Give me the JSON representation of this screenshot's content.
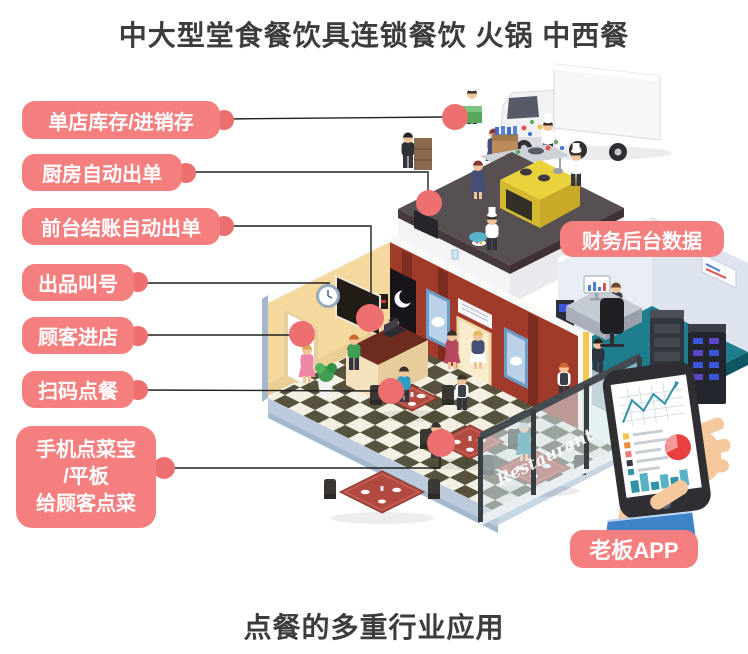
{
  "titles": {
    "top": "中大型堂食餐饮具连锁餐饮 火锅 中西餐",
    "bottom": "点餐的多重行业应用"
  },
  "callouts": {
    "inventory": "单店库存/进销存",
    "kitchen": "厨房自动出单",
    "cashier": "前台结账自动出单",
    "calling": "出品叫号",
    "entry": "顾客进店",
    "scan": "扫码点餐",
    "handheld_lines": [
      "手机点菜宝",
      "/平板",
      "给顾客点菜"
    ],
    "finance": "财务后台数据",
    "boss": "老板APP"
  },
  "scene": {
    "glass_sign": "Restaurant"
  },
  "colors": {
    "label_bg": "#f57f7f",
    "dot": "#ee6f6f",
    "title_text": "#3c3c3c",
    "connector_line": "#1f1f1f"
  }
}
